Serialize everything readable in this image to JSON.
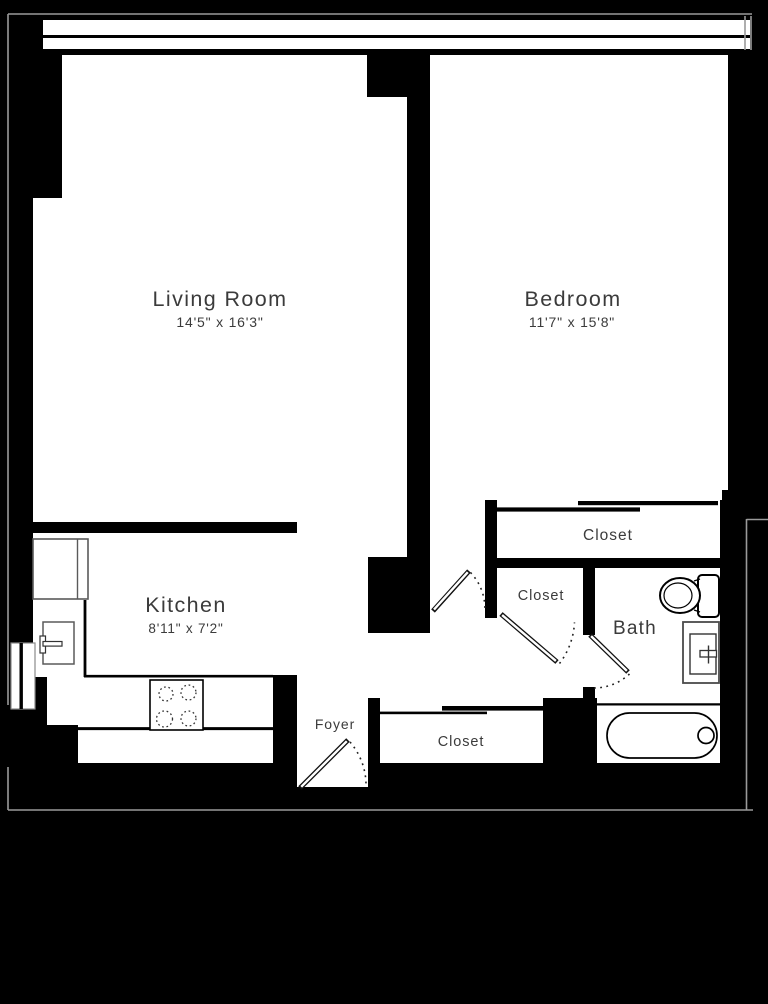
{
  "plan": {
    "type": "apartment-floor-plan",
    "colors": {
      "background": "#000000",
      "floor": "#ffffff",
      "walls": "#000000",
      "text": "#3b3b3b",
      "fixture_outline": "#5a5a5a",
      "exterior_line": "#9a9a9a"
    },
    "rooms": {
      "living_room": {
        "label": "Living Room",
        "dimensions": "14'5\" x 16'3\""
      },
      "bedroom": {
        "label": "Bedroom",
        "dimensions": "11'7\" x 15'8\""
      },
      "kitchen": {
        "label": "Kitchen",
        "dimensions": "8'11\" x 7'2\""
      },
      "bath": {
        "label": "Bath"
      },
      "foyer": {
        "label": "Foyer"
      },
      "closet_bedroom": {
        "label": "Closet"
      },
      "closet_hall": {
        "label": "Closet"
      },
      "closet_foyer": {
        "label": "Closet"
      }
    },
    "fixtures": [
      "refrigerator",
      "kitchen-sink",
      "stove-4-burners",
      "counter",
      "toilet",
      "vanity-sink",
      "bathtub",
      "window-band",
      "side-window"
    ],
    "doors": [
      "bedroom-door",
      "hall-closet-door",
      "bath-door",
      "entry-door"
    ]
  }
}
